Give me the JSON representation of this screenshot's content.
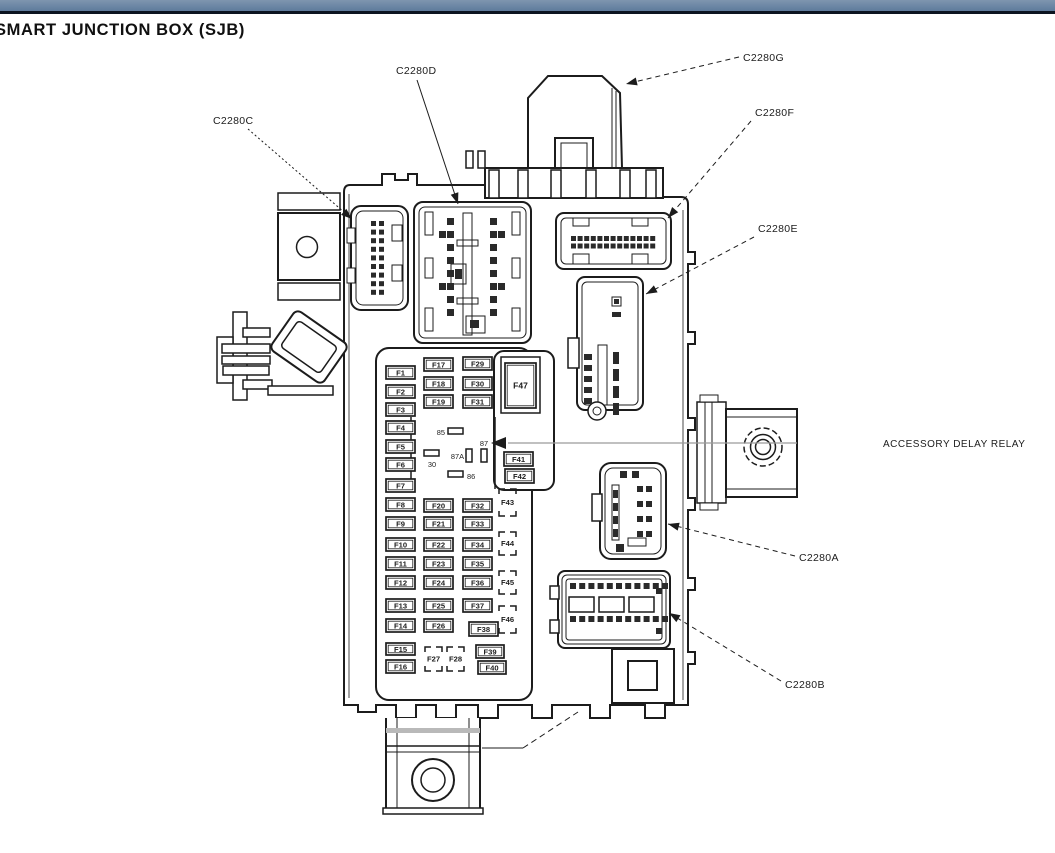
{
  "title": "SMART JUNCTION BOX (SJB)",
  "colors": {
    "ink": "#1c1c1c",
    "bar_top": "#7e95af",
    "bar_bottom": "#5e7b9c",
    "bar_underline": "#0c1420",
    "callout_line_gray": "#9b9b9b"
  },
  "diagram": {
    "connector_callouts": [
      {
        "id": "c2280c",
        "label": "C2280C",
        "tx": 213,
        "ty": 124,
        "x1": 248,
        "y1": 129,
        "x2": 352,
        "y2": 219,
        "dash": "2 2.5"
      },
      {
        "id": "c2280d",
        "label": "C2280D",
        "tx": 396,
        "ty": 74,
        "x1": 417,
        "y1": 80,
        "x2": 458,
        "y2": 204,
        "dash": ""
      },
      {
        "id": "c2280g",
        "label": "C2280G",
        "tx": 743,
        "ty": 61,
        "x1": 739,
        "y1": 57,
        "x2": 626,
        "y2": 84,
        "dash": "5 4"
      },
      {
        "id": "c2280f",
        "label": "C2280F",
        "tx": 755,
        "ty": 116,
        "x1": 751,
        "y1": 121,
        "x2": 668,
        "y2": 218,
        "dash": "5 4"
      },
      {
        "id": "c2280e",
        "label": "C2280E",
        "tx": 758,
        "ty": 232,
        "x1": 754,
        "y1": 237,
        "x2": 646,
        "y2": 294,
        "dash": "5 4"
      },
      {
        "id": "c2280a",
        "label": "C2280A",
        "tx": 799,
        "ty": 561,
        "x1": 795,
        "y1": 556,
        "x2": 668,
        "y2": 524,
        "dash": "5 4"
      },
      {
        "id": "c2280b",
        "label": "C2280B",
        "tx": 785,
        "ty": 688,
        "x1": 781,
        "y1": 681,
        "x2": 669,
        "y2": 613,
        "dash": "5 4"
      }
    ],
    "relay_callout": {
      "label": "ACCESSORY DELAY RELAY",
      "tx": 883,
      "ty": 447,
      "line_x1": 508,
      "line_x2": 797,
      "line_y": 443,
      "arrow_tip_x": 491,
      "arrow_tip_y": 443
    },
    "fuses_xywh": [
      [
        "F1",
        386,
        366,
        29,
        13
      ],
      [
        "F2",
        386,
        385,
        29,
        13
      ],
      [
        "F3",
        386,
        403,
        29,
        13
      ],
      [
        "F4",
        386,
        421,
        29,
        13
      ],
      [
        "F5",
        386,
        440,
        29,
        13
      ],
      [
        "F6",
        386,
        458,
        29,
        13
      ],
      [
        "F7",
        386,
        479,
        29,
        13
      ],
      [
        "F8",
        386,
        498,
        29,
        13
      ],
      [
        "F9",
        386,
        517,
        29,
        13
      ],
      [
        "F10",
        386,
        538,
        29,
        13
      ],
      [
        "F11",
        386,
        557,
        29,
        13
      ],
      [
        "F12",
        386,
        576,
        29,
        13
      ],
      [
        "F13",
        386,
        599,
        29,
        13
      ],
      [
        "F14",
        386,
        619,
        29,
        13
      ],
      [
        "F15",
        386,
        643,
        29,
        12
      ],
      [
        "F16",
        386,
        660,
        29,
        13
      ],
      [
        "F17",
        424,
        358,
        29,
        13
      ],
      [
        "F18",
        424,
        377,
        29,
        13
      ],
      [
        "F19",
        424,
        395,
        29,
        13
      ],
      [
        "F20",
        424,
        499,
        29,
        13
      ],
      [
        "F21",
        424,
        517,
        29,
        13
      ],
      [
        "F22",
        424,
        538,
        29,
        13
      ],
      [
        "F23",
        424,
        557,
        29,
        13
      ],
      [
        "F24",
        424,
        576,
        29,
        13
      ],
      [
        "F25",
        424,
        599,
        29,
        13
      ],
      [
        "F26",
        424,
        619,
        29,
        13
      ],
      [
        "F29",
        463,
        357,
        29,
        13
      ],
      [
        "F30",
        463,
        377,
        29,
        13
      ],
      [
        "F31",
        463,
        395,
        29,
        13
      ],
      [
        "F32",
        463,
        499,
        29,
        13
      ],
      [
        "F33",
        463,
        517,
        29,
        13
      ],
      [
        "F34",
        463,
        538,
        29,
        13
      ],
      [
        "F35",
        463,
        557,
        29,
        13
      ],
      [
        "F36",
        463,
        576,
        29,
        13
      ],
      [
        "F37",
        463,
        599,
        29,
        13
      ],
      [
        "F38",
        469,
        622,
        29,
        14
      ],
      [
        "F39",
        476,
        645,
        28,
        13
      ],
      [
        "F40",
        478,
        661,
        28,
        13
      ],
      [
        "F41",
        504,
        452,
        29,
        14
      ],
      [
        "F42",
        505,
        469,
        29,
        14
      ],
      [
        "F47",
        505,
        363,
        31,
        45
      ]
    ],
    "dashed_fuses_xy1y2w": [
      [
        "F27",
        425,
        647,
        671,
        17
      ],
      [
        "F28",
        447,
        647,
        671,
        17
      ],
      [
        "F43",
        499,
        489,
        516,
        17
      ],
      [
        "F44",
        499,
        532,
        555,
        17
      ],
      [
        "F45",
        499,
        571,
        594,
        17
      ],
      [
        "F46",
        499,
        606,
        633,
        17
      ]
    ],
    "relay_pins": [
      {
        "label": "85",
        "anchor": "end",
        "lx": 445,
        "ly": 435,
        "pin": [
          448,
          428,
          15,
          6
        ]
      },
      {
        "label": "30",
        "anchor": "middle",
        "lx": 432,
        "ly": 467,
        "pin": [
          424,
          450,
          15,
          6
        ]
      },
      {
        "label": "86",
        "anchor": "start",
        "lx": 467,
        "ly": 479,
        "pin": [
          448,
          471,
          15,
          6
        ]
      },
      {
        "label": "87",
        "anchor": "middle",
        "lx": 484,
        "ly": 446,
        "pin": [
          481,
          449,
          6,
          13
        ]
      },
      {
        "label": "87A",
        "anchor": "end",
        "lx": 464,
        "ly": 459,
        "pin": [
          466,
          449,
          6,
          13
        ]
      }
    ]
  }
}
